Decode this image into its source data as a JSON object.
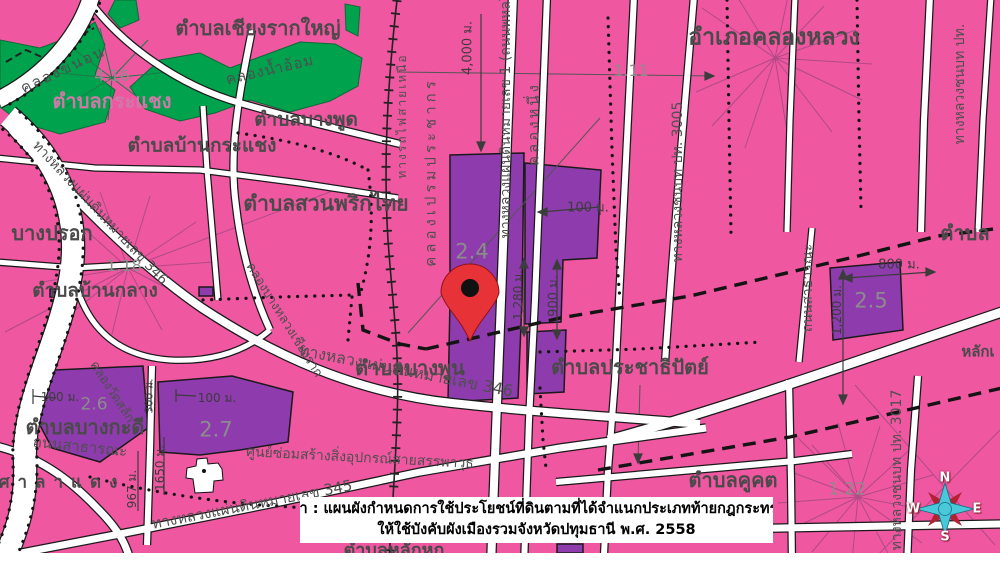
{
  "colors": {
    "background_pink": "#ef57a1",
    "agriculture_green": "#00a24e",
    "zone_purple": "#8e3bae",
    "road_white": "#ffffff",
    "boundary_black": "#141414",
    "pin_red": "#e73238",
    "compass_cyan": "#49c8da",
    "compass_red": "#b22233",
    "caption_background": "#ffffff"
  },
  "caption": {
    "line1": "ที่มา : แผนผังกำหนดการใช้ประโยชน์ที่ดินตามที่ได้จำแนกประเภทท้ายกฎกระทรวง",
    "line2": "ให้ใช้บังคับผังเมืองรวมจังหวัดปทุมธานี พ.ศ. 2558"
  },
  "compass": {
    "north": "N",
    "east": "E",
    "south": "S",
    "west": "W"
  },
  "districts": {
    "chiang_rak_yai": "ตำบลเชียงรากใหญ่",
    "krachaeng": "ตำบลกระแชง",
    "bang_pud": "ตำบลบางพูด",
    "ban_krachaeng": "ตำบลบ้านกระแชง",
    "suan_phrik_thai": "ตำบลสวนพริกไทย",
    "amphoe_khlong_luang": "อำเภอคลองหลวง",
    "bang_prok": "บางปรอก",
    "ban_klang": "ตำบลบ้านกลาง",
    "bang_phun": "ตำบลบางพูน",
    "prachathipat": "ตำบลประชาธิปัตย์",
    "bang_kadi": "ตำบลบางกะดี",
    "sala_daeng": "ศาลาแดง",
    "khu_khot": "ตำบลคูคต",
    "lak_hok_partial": "ตำบลหลักหก",
    "tambon_right_partial": "ตำบล",
    "lak_right_partial": "หลักเ"
  },
  "zone_numbers": {
    "z416": "4.16",
    "z111": "1.11",
    "z118": "1.18",
    "z24": "2.4",
    "z25": "2.5",
    "z26": "2.6",
    "z27": "2.7",
    "z122": "1.22"
  },
  "measurements": {
    "m4000": "4,000 ม.",
    "m100_center": "100 ม.",
    "m1280": "1,280 ม.",
    "m900": "900 ม.",
    "m800": "800 ม.",
    "m1200": "1,200 ม.",
    "m100_z26": "100 ม.",
    "m100_z27": "100 ม.",
    "m967": "967 ม.",
    "m1650": "1650 ม.",
    "m300": "300 ม."
  },
  "roads": {
    "khlong_khanon": "คลองขนอน",
    "khlong_nam_om": "คลองน้ำอ้อม",
    "hwy346_left": "ทางหลวงแผ่นดินหมายเลข 346",
    "khlong_prem_prachakon": "คลองเปรมประชากร",
    "hwy1_phahonyothin": "ทางหลวงแผ่นดินหมายเลข 1 (ถนนพหลโยธิน)",
    "khlong_nueng": "คลองหนึ่ง",
    "rural_3005": "ทางหลวงชนบท ปท. 3005",
    "rural_pt_partial": "ทางหลวงชนบท ปท.",
    "rural_3017": "ทางหลวงชนบท ปท. 3017",
    "hwy346_center": "ทางหลวงแผ่นดินหมายเลข 346",
    "hwy345": "ทางหลวงแผ่นดินหมายเลข 345",
    "public_road_sw": "ถนนสาธารณะ",
    "public_road_e": "ถนนสาธารณะ",
    "railway_north": "ทางรถไฟสายเหนือ",
    "khlong_wat_salak": "คลองวัดสลัก",
    "khlong_bang_luang_chiang_rak": "คลองบางหลวงเชียงราก",
    "ordnance_center": "ศูนย์ซ่อมสร้างสิ่งอุปกรณ์สายสรรพาวุธ"
  }
}
